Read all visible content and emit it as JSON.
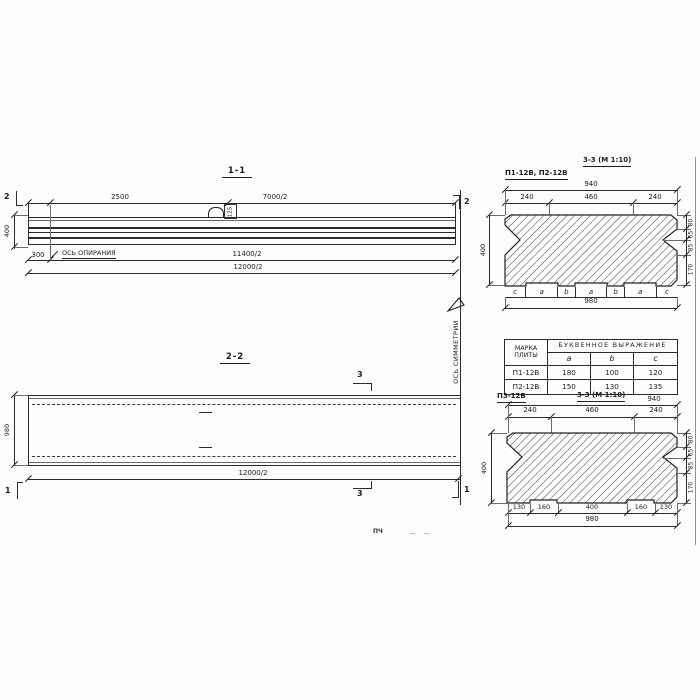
{
  "s11": {
    "title": "1-1",
    "dim_a": "2500",
    "dim_b": "7000/2",
    "dim_300": "300",
    "bearing_axis": "ОСЬ ОПИРАНИЯ",
    "dim_c": "11400/2",
    "dim_d": "12000/2",
    "height": "400",
    "marker": "2",
    "loop_tag": "125"
  },
  "s22": {
    "title": "2-2",
    "width": "980",
    "dim": "12000/2",
    "marker1": "1",
    "marker3": "3",
    "symmetry_axis": "ОСЬ СИММЕТРИИ"
  },
  "st": {
    "marks": "П1-12В, П2-12В",
    "title": "3-3 (М 1:10)",
    "top": "940",
    "seg": [
      "240",
      "460",
      "240"
    ],
    "height": "400",
    "right": [
      "80",
      "65",
      "85",
      "170"
    ],
    "letters": [
      "с",
      "а",
      "b",
      "а",
      "b",
      "а",
      "с"
    ],
    "bottom": "980"
  },
  "tbl": {
    "h_mark_1": "МАРКА",
    "h_mark_2": "ПЛИТЫ",
    "h_expr": "БУКВЕННОЕ ВЫРАЖЕНИЕ",
    "cols": [
      "a",
      "b",
      "c"
    ],
    "rows": [
      [
        "П1-12В",
        "180",
        "100",
        "120"
      ],
      [
        "П2-12В",
        "150",
        "130",
        "135"
      ]
    ]
  },
  "sb": {
    "mark": "П3-12В",
    "title": "3-3 (М 1:10)",
    "top": "940",
    "seg": [
      "240",
      "460",
      "240"
    ],
    "height": "400",
    "right": [
      "80",
      "65",
      "85",
      "170"
    ],
    "bottom_seg": [
      "130",
      "160",
      "400",
      "160",
      "130"
    ],
    "bottom": "980"
  },
  "artifact": "ПЧ"
}
